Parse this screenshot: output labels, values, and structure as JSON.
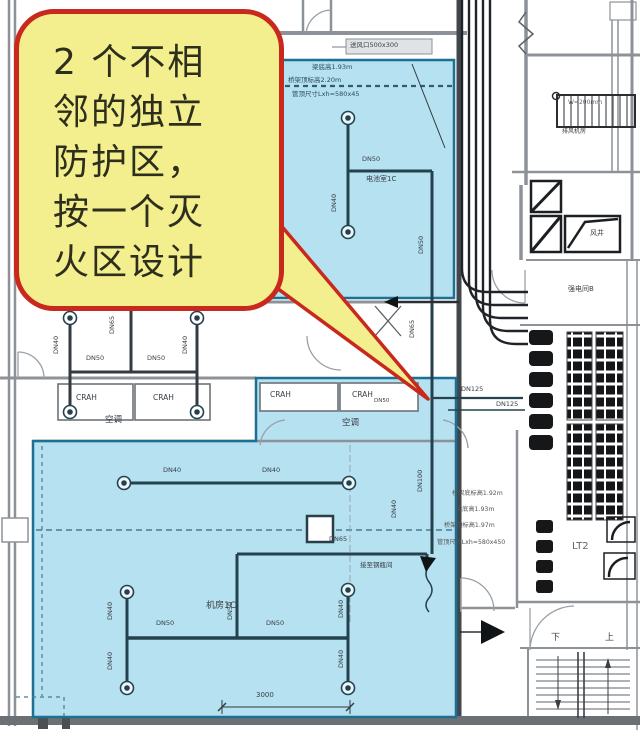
{
  "callout": {
    "lines": [
      "2 个不相",
      "邻的独立",
      "防护区，",
      "按一个灭",
      "火区设计"
    ]
  },
  "pipe_labels": {
    "dn40": "DN40",
    "dn50": "DN50",
    "dn65": "DN65",
    "dn100": "DN100",
    "dn125": "DN125"
  },
  "equipment": {
    "crah": "CRAH"
  },
  "rooms": {
    "hvac": "空调",
    "battery_room": "电池室1C",
    "machine_room": "机房1C",
    "strong_electric_room": "强电间B",
    "air_shaft": "风井",
    "fan_room": "排风机房",
    "elevator": "LT2",
    "stair_down": "下",
    "stair_up": "上"
  },
  "annotations": {
    "top_zone_line1": "梁底高1.93m",
    "top_zone_line2": "桥架顶标高2.20m",
    "top_zone_line3": "管顶尺寸Lxh=580x45",
    "right_line1": "桥架底标高1.92m",
    "right_line2": "梁底高1.93m",
    "right_line3": "桥架顶标高1.97m",
    "right_line4": "管顶尺寸Lxh=580x450",
    "vent_label": "送风口500x300",
    "tray_label": "W=200mm",
    "connect_label": "接至钢瓶间",
    "dim_3000": "3000"
  },
  "colors": {
    "zone_fill": "#b5e1f0",
    "zone_border": "#1d6f94",
    "callout_fill": "#f3ee8e",
    "callout_border": "#c9281c",
    "callout_text": "#2e2e1d",
    "wall_gray": "#8d9298",
    "line_dark": "#24424e",
    "panel_black": "#141619"
  }
}
